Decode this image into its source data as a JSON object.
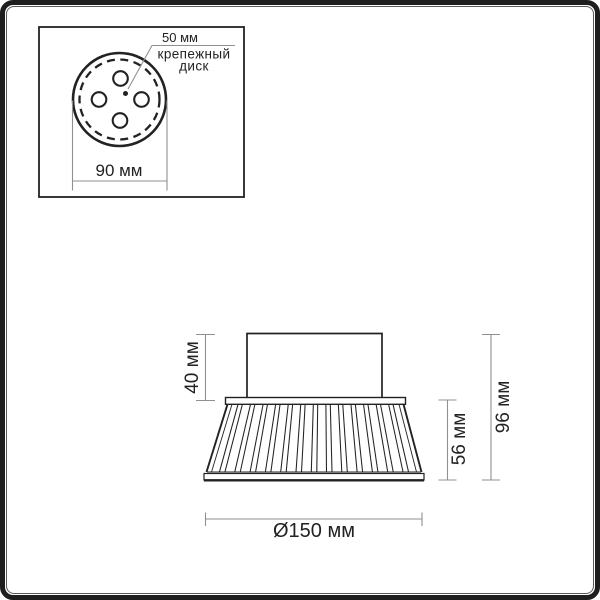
{
  "colors": {
    "background": "#ffffff",
    "frame": "#1e1e1e",
    "drawing_line": "#222222",
    "dimension_line": "#909090"
  },
  "top_view_inset": {
    "center_spacing_label": "50 мм",
    "part_label_line1": "крепежный",
    "part_label_line2": "диск",
    "disk_width_label": "90 мм"
  },
  "side_view": {
    "mount_height_label": "40 мм",
    "shade_height_label": "56 мм",
    "total_height_label": "96 мм",
    "diameter_label": "Ø150 мм"
  }
}
